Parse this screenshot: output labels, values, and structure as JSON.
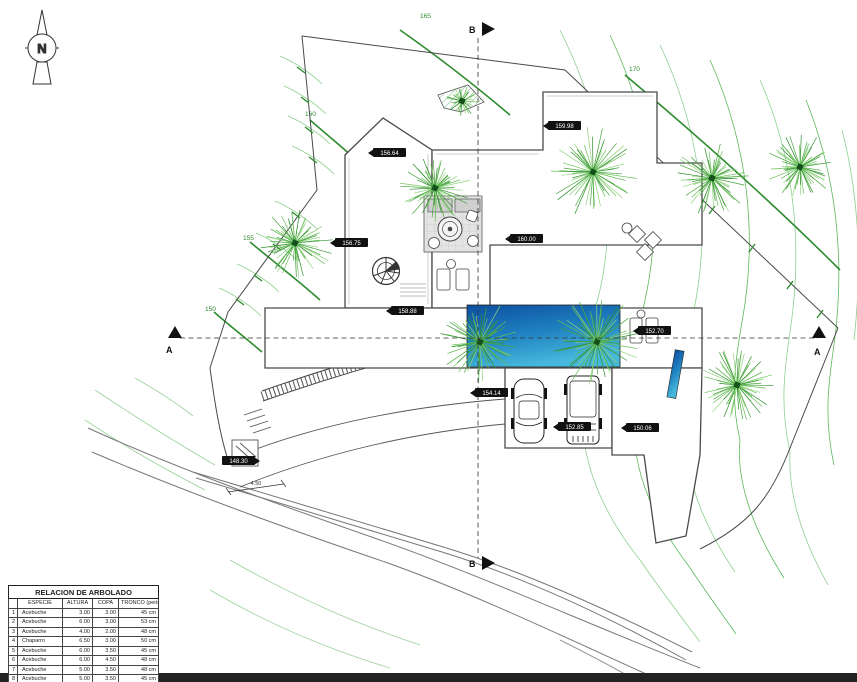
{
  "drawing": {
    "compass_label": "N",
    "section_markers": {
      "a_left": "A",
      "a_right": "A",
      "b_top": "B",
      "b_bottom": "B"
    },
    "contour_labels": {
      "c165": "165",
      "c170": "170",
      "c160": "160",
      "c155": "155",
      "c150": "150"
    },
    "spot_elevations": {
      "e1": "156.64",
      "e2": "159.98",
      "e3": "156.75",
      "e4": "160.00",
      "e5": "158.88",
      "e6": "154.14",
      "e7": "152.70",
      "e8": "152.85",
      "e9": "150.06",
      "e10": "148.30"
    },
    "dimensions": {
      "driveway_width": "4.50"
    }
  },
  "tree_table": {
    "title": "RELACION DE ARBOLADO",
    "columns": {
      "num": "",
      "especie": "ESPECIE",
      "altura": "ALTURA",
      "copa": "COPA",
      "tronco": "TRONCO (perimetro)"
    },
    "rows": [
      {
        "num": "1",
        "especie": "Acebuche",
        "altura": "3.00",
        "copa": "3.00",
        "tronco": "45 cm"
      },
      {
        "num": "2",
        "especie": "Acebuche",
        "altura": "6.00",
        "copa": "3.00",
        "tronco": "53 cm"
      },
      {
        "num": "3",
        "especie": "Acebuche",
        "altura": "4.00",
        "copa": "2.00",
        "tronco": "48 cm"
      },
      {
        "num": "4",
        "especie": "Chaparro",
        "altura": "6.50",
        "copa": "3.00",
        "tronco": "50 cm"
      },
      {
        "num": "5",
        "especie": "Acebuche",
        "altura": "6.00",
        "copa": "3.50",
        "tronco": "45 cm"
      },
      {
        "num": "6",
        "especie": "Acebuche",
        "altura": "6.00",
        "copa": "4.50",
        "tronco": "48 cm"
      },
      {
        "num": "7",
        "especie": "Acebuche",
        "altura": "5.00",
        "copa": "3.50",
        "tronco": "48 cm"
      },
      {
        "num": "8",
        "especie": "Acebuche",
        "altura": "5.00",
        "copa": "3.50",
        "tronco": "45 cm"
      }
    ]
  },
  "colors": {
    "contour_green": "#3f9e3f",
    "pool_dark": "#0d4f9e",
    "pool_light": "#45b8dc",
    "label_bg": "#111111"
  }
}
